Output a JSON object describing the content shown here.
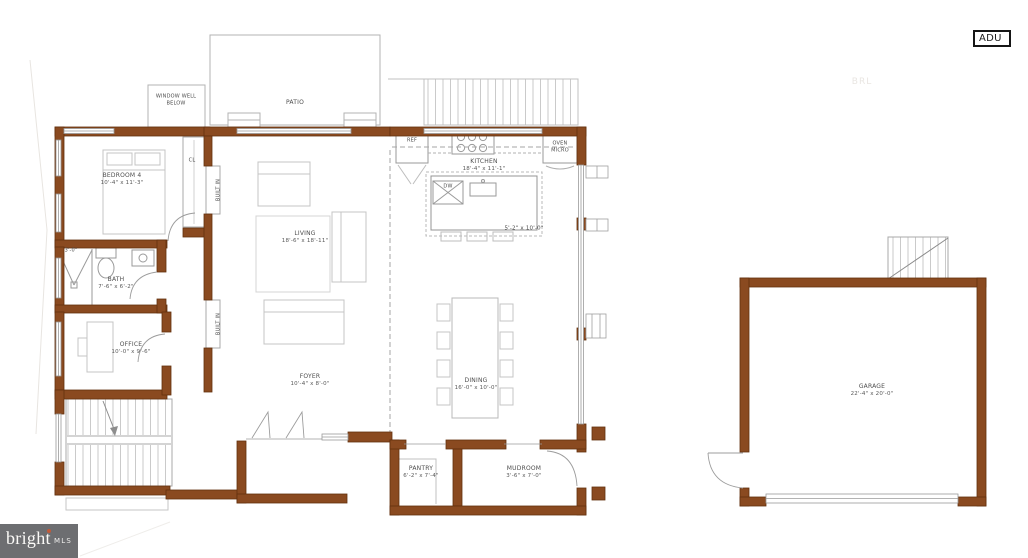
{
  "document": {
    "type_label": "ADU"
  },
  "watermark": {
    "brand": "bright",
    "suffix": "MLS"
  },
  "colors": {
    "wall_fill": "#8a4a20",
    "wall_stroke": "#63300e",
    "line_gray": "#9c9c9c",
    "watermark_bg": "#6d6e71",
    "watermark_dot": "#c05a3a"
  },
  "rooms": {
    "bedroom4": {
      "name": "BEDROOM 4",
      "dims": "10'-4\" x 11'-3\""
    },
    "bath": {
      "name": "BATH",
      "dims": "7'-6\" x 6'-2\""
    },
    "office": {
      "name": "OFFICE",
      "dims": "10'-0\" x 9'-6\""
    },
    "living": {
      "name": "LIVING",
      "dims": "18'-6\" x 18'-11\""
    },
    "foyer": {
      "name": "FOYER",
      "dims": "10'-4\" x 8'-0\""
    },
    "kitchen": {
      "name": "KITCHEN",
      "dims": "18'-4\" x 11'-1\""
    },
    "dining": {
      "name": "DINING",
      "dims": "16'-0\" x 10'-0\""
    },
    "pantry": {
      "name": "PANTRY",
      "dims": "6'-2\" x 7'-4\""
    },
    "mudroom": {
      "name": "MUDROOM",
      "dims": "3'-6\" x 7'-0\""
    },
    "garage": {
      "name": "GARAGE",
      "dims": "22'-4\" x 20'-0\""
    },
    "patio": {
      "name": "PATIO"
    }
  },
  "annotations": {
    "window_well_line1": "WINDOW WELL",
    "window_well_line2": "BELOW",
    "closet": "CL",
    "built_in_upper": "BUILT IN",
    "built_in_lower": "BUILT IN",
    "ref": "REF",
    "oven": "OVEN",
    "micro": "MICRO",
    "dw": "DW",
    "island_dims": "5'-2\" x 10'-0\"",
    "shower_dim": "3'-0\"",
    "brl": "BRL"
  }
}
